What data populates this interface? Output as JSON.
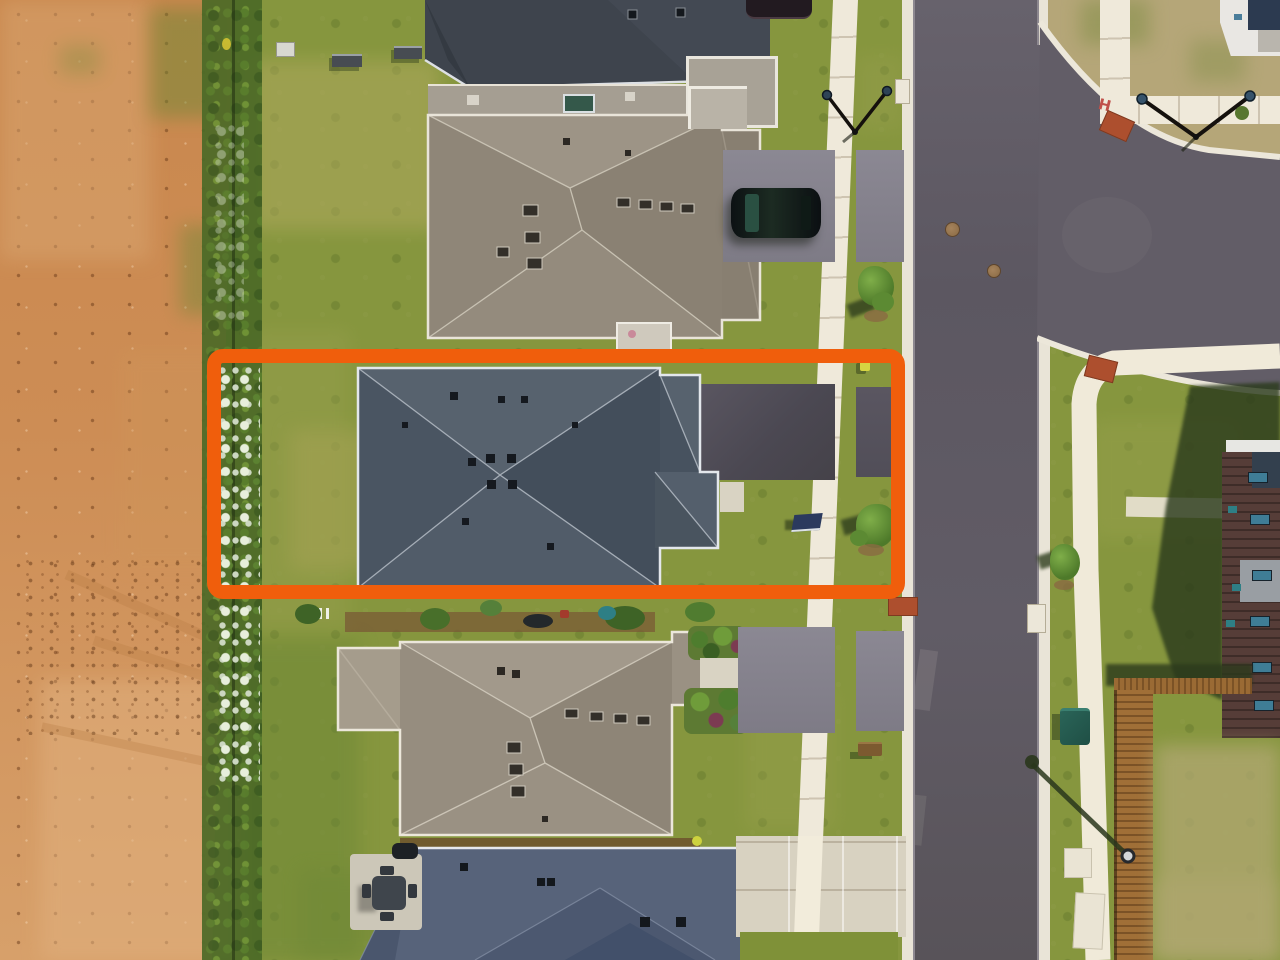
{
  "scene": {
    "type": "aerial-drone-photograph",
    "setting": "new suburban residential street beside a bare dirt field",
    "annotation": "orange rounded rectangle outlining one property lot (house, yard and driveway)"
  },
  "highlight": {
    "shape": "rounded-rectangle",
    "color": "#F05E0C",
    "border_px": 14
  },
  "sidewalk_marking": {
    "text": "H",
    "color": "#C0504A"
  },
  "objects": {
    "houses": [
      "charcoal-roof-house-top",
      "tan-roof-house-upper",
      "highlighted-slate-roof-house",
      "tan-roof-house-lower",
      "blue-gray-roof-house-bottom",
      "red-brick-house-right"
    ],
    "vehicles": [
      "dark-suv-on-driveway",
      "dark-car-partial-top-edge"
    ],
    "street_furniture": [
      "double-arm-streetlight-left",
      "double-arm-streetlight-top-right",
      "streetlight-bottom-right",
      "fire-hydrant-yellow",
      "teal-trash-bin",
      "manhole-covers",
      "red-concrete-pads",
      "curb-catch-basins"
    ],
    "yard_items": [
      "picnic-benches",
      "patio-table-set",
      "young-street-trees",
      "wooden-privacy-fence",
      "white-flower-hedgerow",
      "garden-beds"
    ]
  },
  "palette": {
    "dirt_field": "#CD8C53",
    "grass": "#86963E",
    "road_asphalt": "#5F5A64",
    "sidewalk_concrete": "#EFE9DA",
    "roof_charcoal": "#3E444D",
    "roof_tan": "#968D80",
    "roof_slate_highlighted": "#4F5A68",
    "roof_blue_gray": "#57637A",
    "driveway_dark": "#4B4852",
    "concrete_driveway": "#D8D2C1"
  }
}
